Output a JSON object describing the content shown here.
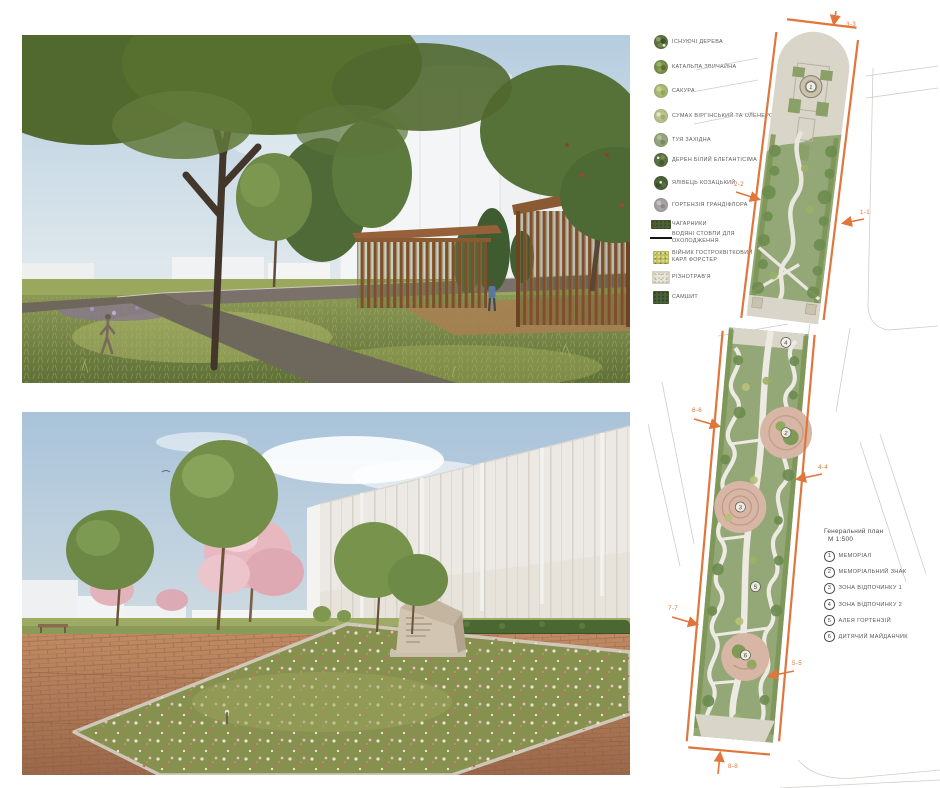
{
  "board": {
    "type": "landscape-architecture presentation sheet",
    "background": "#ffffff"
  },
  "legend": {
    "items": [
      {
        "icon": "existing-trees-symbol",
        "label": "ІСНУЮЧІ ДЕРЕВА",
        "color": "#5e7342"
      },
      {
        "icon": "catalpa-symbol",
        "label": "КАТАЛЬПА ЗВИЧАЙНА",
        "color": "#7a8f4e"
      },
      {
        "icon": "sakura-symbol",
        "label": "САКУРА",
        "color": "#a9ba74"
      },
      {
        "icon": "sumac-symbol",
        "label": "СУМАХ ВІРГІНСЬКИЙ ТА ОЛЕНЕРОГИЙ",
        "color": "#b7c28e"
      },
      {
        "icon": "thuja-symbol",
        "label": "ТУЯ ЗАХІДНА",
        "color": "#96a47f"
      },
      {
        "icon": "dogwood-symbol",
        "label": "ДЕРЕН БІЛИЙ ЕЛЕГАНТІСІМА",
        "color": "#5b7146"
      },
      {
        "icon": "juniper-symbol",
        "label": "ЯЛІВЕЦЬ КОЗАЦЬКИЙ",
        "color": "#4c6138"
      },
      {
        "icon": "hydrangea-symbol",
        "label": "ГОРТЕНЗІЯ ГРАНДІФЛОРА",
        "color": "#a7a1a2"
      },
      {
        "icon": "shrubs-swatch",
        "label": "ЧАГАРНИКИ",
        "color": "#4d6136"
      },
      {
        "icon": "water-columns-line",
        "label": "ВОДЯНІ СТОВПИ ДЛЯ\nОХОЛОДЖЕННЯ",
        "color": "#151515"
      },
      {
        "icon": "reed-grass-swatch",
        "label": "ВІЙНИК ГОСТРОКВІТКОВИЙ\nКАРЛ ФОРСТЕР",
        "color": "#c2c06a"
      },
      {
        "icon": "meadow-mix-swatch",
        "label": "РІЗНОТРАВ'Я",
        "color": "#e9e6d8"
      },
      {
        "icon": "boxwood-swatch",
        "label": "САМШИТ",
        "color": "#4a6038"
      }
    ]
  },
  "plan_top": {
    "sections": {
      "s33": "3-3",
      "s22": "2-2",
      "s11": "1-1"
    },
    "markers": {
      "m1": "1"
    }
  },
  "plan_bottom": {
    "sections": {
      "s66": "6-6",
      "s44": "4-4",
      "s77": "7-7",
      "s55": "5-5",
      "s88": "8-8"
    },
    "markers": {
      "m2": "2",
      "m3": "3",
      "m4": "4",
      "m5": "5",
      "m6": "6"
    }
  },
  "general_plan": {
    "title": "Генеральний план",
    "scale": "М 1:500",
    "items": [
      {
        "num": "1",
        "label": "МЕМОРІАЛ"
      },
      {
        "num": "2",
        "label": "МЕМОРІАЛЬНИЙ ЗНАК"
      },
      {
        "num": "3",
        "label": "ЗОНА ВІДПОЧИНКУ 1"
      },
      {
        "num": "4",
        "label": "ЗОНА ВІДПОЧИНКУ 2"
      },
      {
        "num": "5",
        "label": "АЛЕЯ ГОРТЕНЗІЙ"
      },
      {
        "num": "6",
        "label": "ДИТЯЧИЙ МАЙДАНЧИК"
      }
    ]
  },
  "colors": {
    "section_line_orange": "#e0763c",
    "plan_green": "#93a876",
    "plan_tree_green": "#6f8d50",
    "plan_plaza_beige": "#d9d5c8",
    "plan_zone_pink": "#d8b6a5",
    "render_sky": "#b9cfdf",
    "render_grass": "#7d8f4c",
    "render_brick": "#b07a55",
    "render_wood": "#8a5a33"
  }
}
